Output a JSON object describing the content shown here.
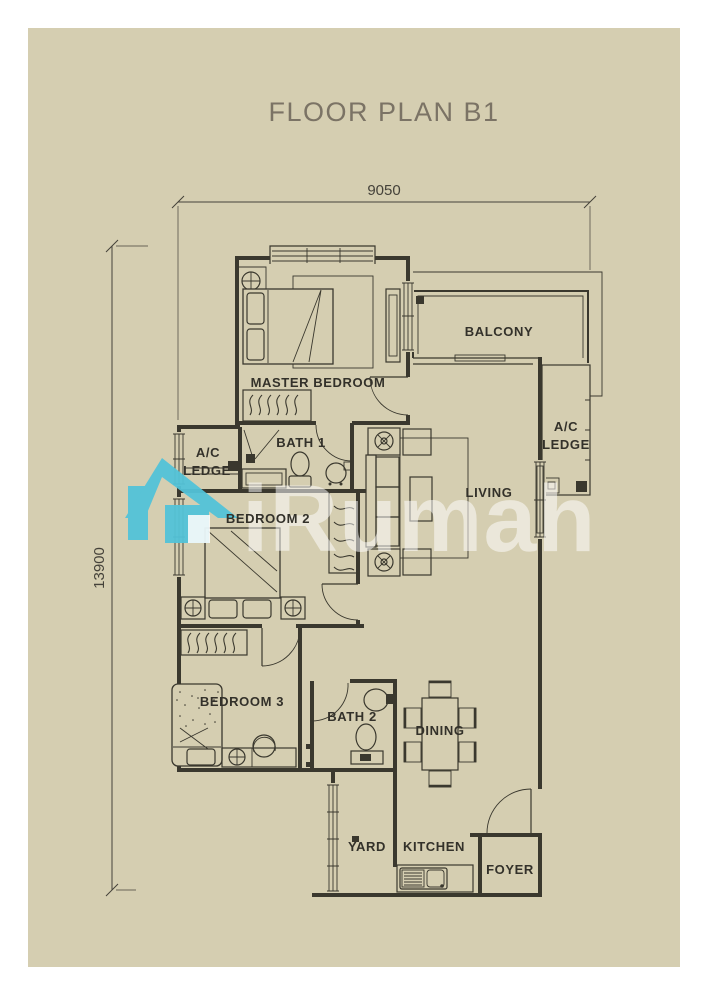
{
  "title": "FLOOR PLAN B1",
  "dimensions": {
    "width": "9050",
    "height": "13900"
  },
  "rooms": {
    "master_bedroom": "MASTER BEDROOM",
    "balcony": "BALCONY",
    "ac": "A/C",
    "ledge": "LEDGE",
    "bath_1": "BATH 1",
    "bedroom_2": "BEDROOM 2",
    "living": "LIVING",
    "bedroom_3": "BEDROOM 3",
    "bath_2": "BATH 2",
    "dining": "DINING",
    "yard": "YARD",
    "kitchen": "KITCHEN",
    "foyer": "FOYER"
  },
  "watermark": {
    "text": "iRumah",
    "brand_color": "#53c3d8",
    "text_color": "rgba(255,255,255,0.52)"
  },
  "colors": {
    "paper": "#d5ceb1",
    "wall": "#3a382e",
    "title": "#7b7365",
    "label": "#33312a",
    "dimension": "#45423a"
  }
}
